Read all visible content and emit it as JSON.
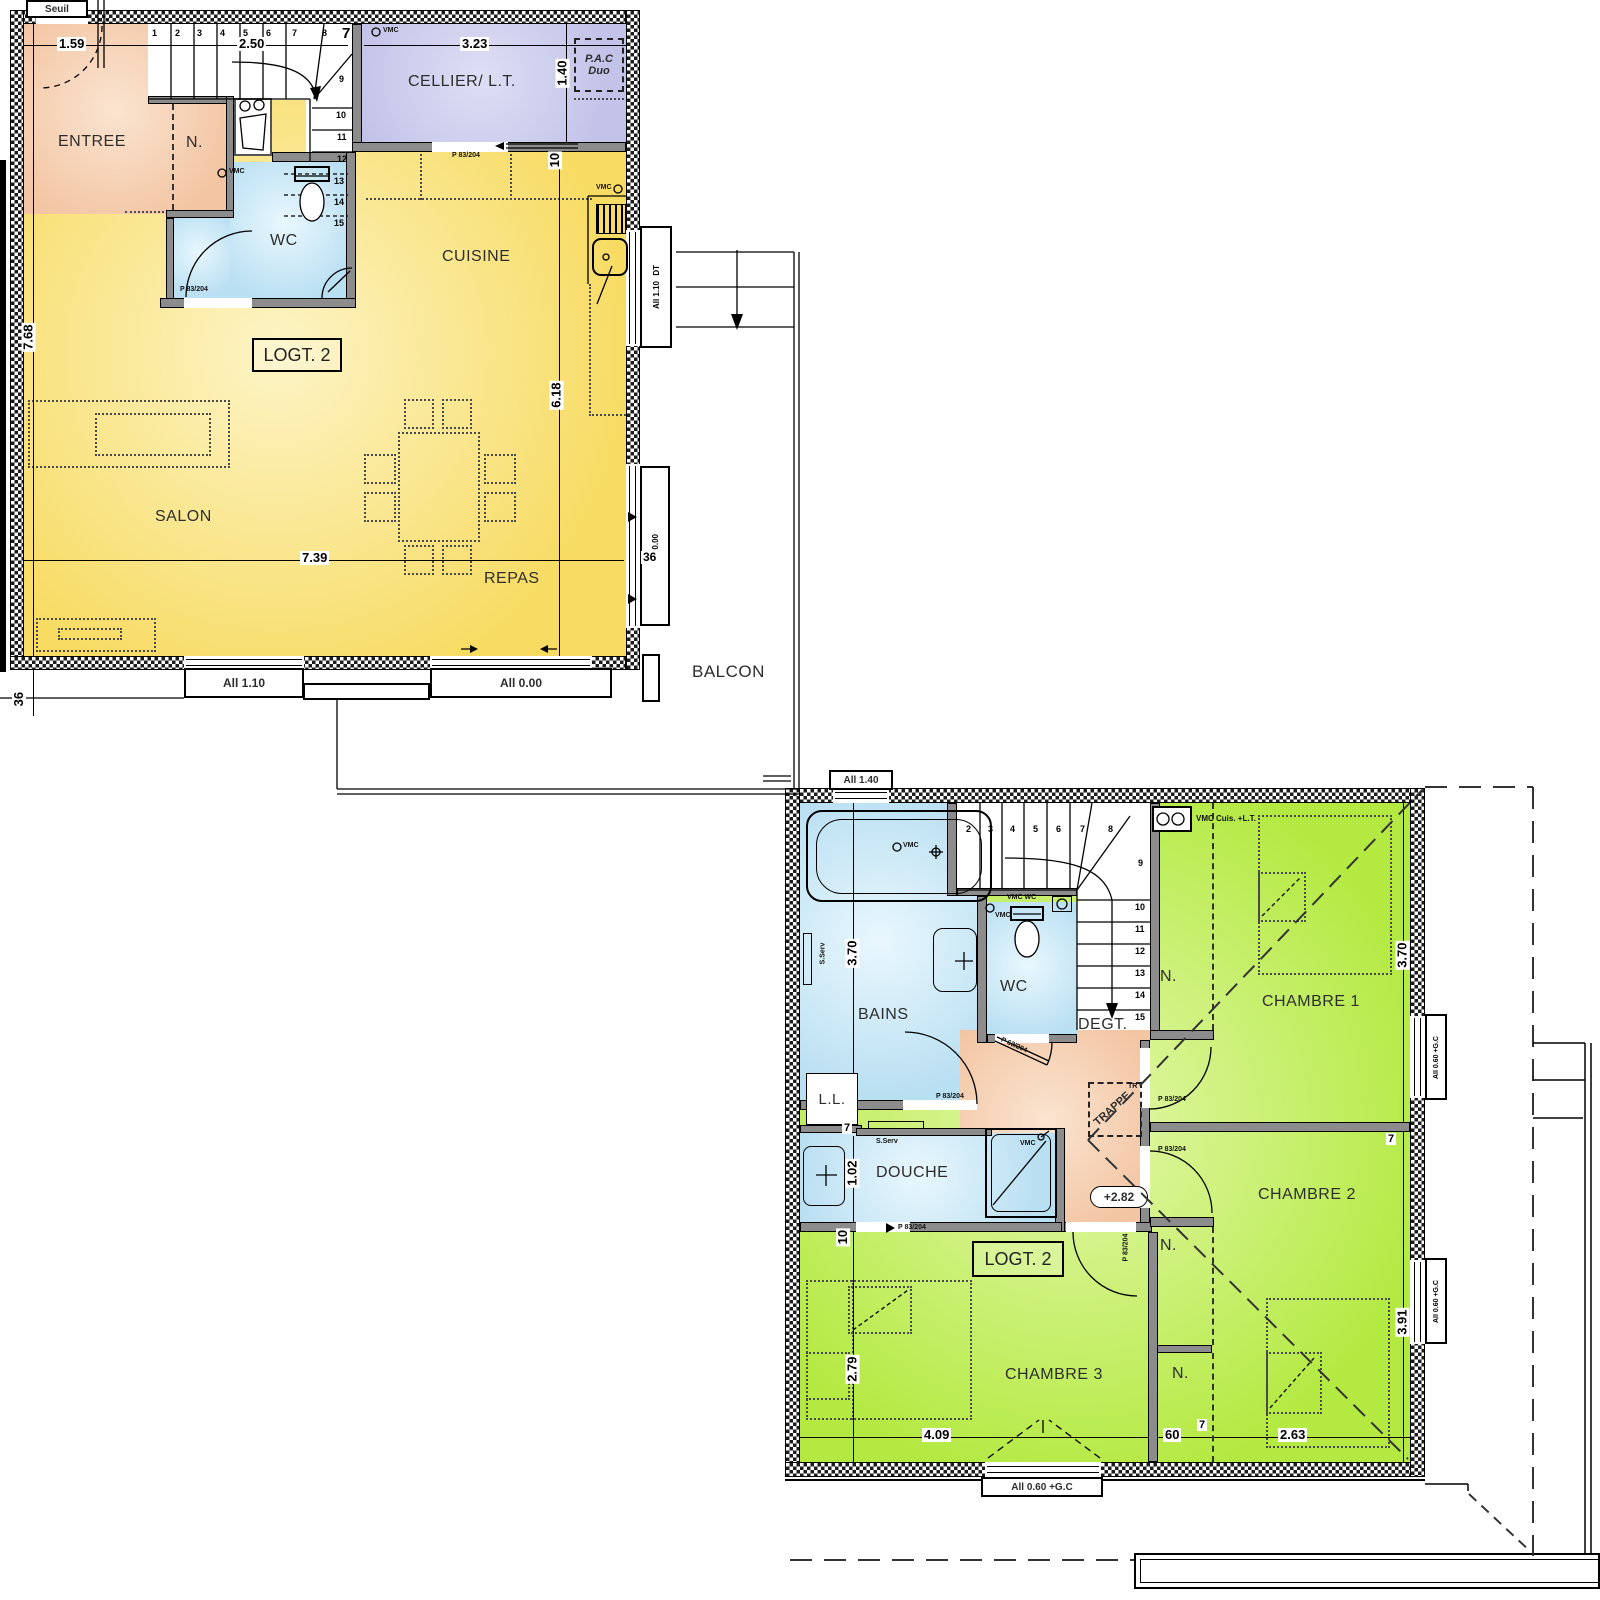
{
  "ground": {
    "title_box": "LOGT. 2",
    "rooms": {
      "entree": "ENTREE",
      "closet_n": "N.",
      "wc": "WC",
      "cellier": "CELLIER/ L.T.",
      "cuisine": "CUISINE",
      "salon": "SALON",
      "repas": "REPAS"
    },
    "outside": {
      "seuil": "Seuil",
      "balcon": "BALCON"
    },
    "equipment": {
      "pac1": "P.A.C",
      "pac2": "Duo",
      "vmc": "VMC"
    },
    "door_label": "P 83/204",
    "windows": {
      "bottom_left": "All 1.10",
      "bottom_center": "All 0.00",
      "right_top_tag": "DT",
      "right_top": "All 1.10",
      "right_low": "A 0.00"
    },
    "dims": {
      "entree_w": "1.59",
      "stairs_w": "2.50",
      "wall7": "7",
      "cellier_w": "3.23",
      "pac_h": "1.40",
      "left_h": "7.68",
      "kitchen_h": "6.18",
      "salon_w": "7.39",
      "door_off": "10",
      "sill_bl": "36",
      "sill_r": "36"
    },
    "stairs": [
      "1",
      "2",
      "3",
      "4",
      "5",
      "6",
      "7",
      "8",
      "9",
      "10",
      "11",
      "12",
      "13",
      "14",
      "15"
    ]
  },
  "upper": {
    "title_box": "LOGT. 2",
    "rooms": {
      "bains": "BAINS",
      "wc": "WC",
      "degt": "DEGT.",
      "douche": "DOUCHE",
      "ll": "L.L.",
      "ch1": "CHAMBRE 1",
      "ch2": "CHAMBRE 2",
      "ch3": "CHAMBRE 3",
      "closet_n": "N."
    },
    "equipment": {
      "vmc": "VMC",
      "vmc_wc": "VMC WC",
      "vmc_cuis": "VMC Cuis. +L.T.",
      "sserv": "S.Serv",
      "trappe": "TRAPPE",
      "tr": "TR",
      "level": "+2.82"
    },
    "door_label": "P 83/204",
    "door_label_wc": "P 63/204",
    "windows": {
      "top": "All 1.40",
      "right": "All 0.60 +G.C",
      "bottom": "All 0.60 +G.C"
    },
    "dims": {
      "bains_h": "3.70",
      "ch1_h": "3.70",
      "wall7": "7",
      "douche_h": "1.02",
      "wall10": "10",
      "ch3_h": "2.79",
      "ch2_h": "3.91",
      "ch3_w": "4.09",
      "closet_w": "60",
      "ch2_w": "2.63"
    },
    "stairs": [
      "2",
      "3",
      "4",
      "5",
      "6",
      "7",
      "8",
      "9",
      "10",
      "11",
      "12",
      "13",
      "14",
      "15"
    ]
  }
}
